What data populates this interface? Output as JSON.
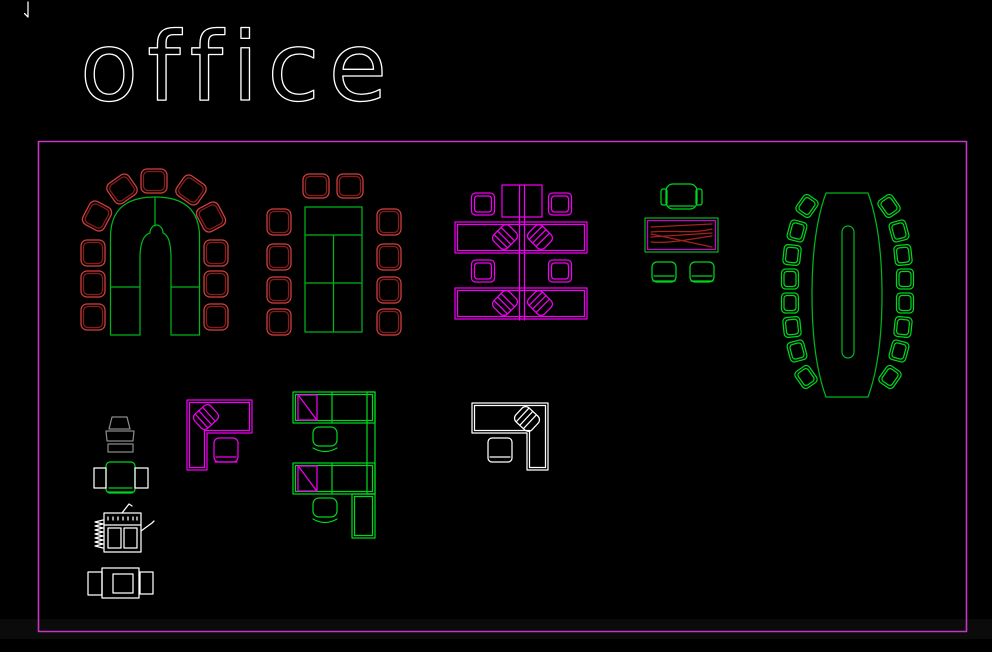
{
  "title": {
    "text": "office"
  },
  "colors": {
    "bg": "#000000",
    "border": "#c438c4",
    "white": "#ffffff",
    "gray": "#8a8a8a",
    "green-table": "#00b41e",
    "green-chair": "#00d41e",
    "red-outer": "#d24040",
    "red-inner": "#8c1a1a",
    "red-grain": "#aa1f1f",
    "magenta": "#f000f0",
    "magenta-dim": "#cf00cf"
  }
}
